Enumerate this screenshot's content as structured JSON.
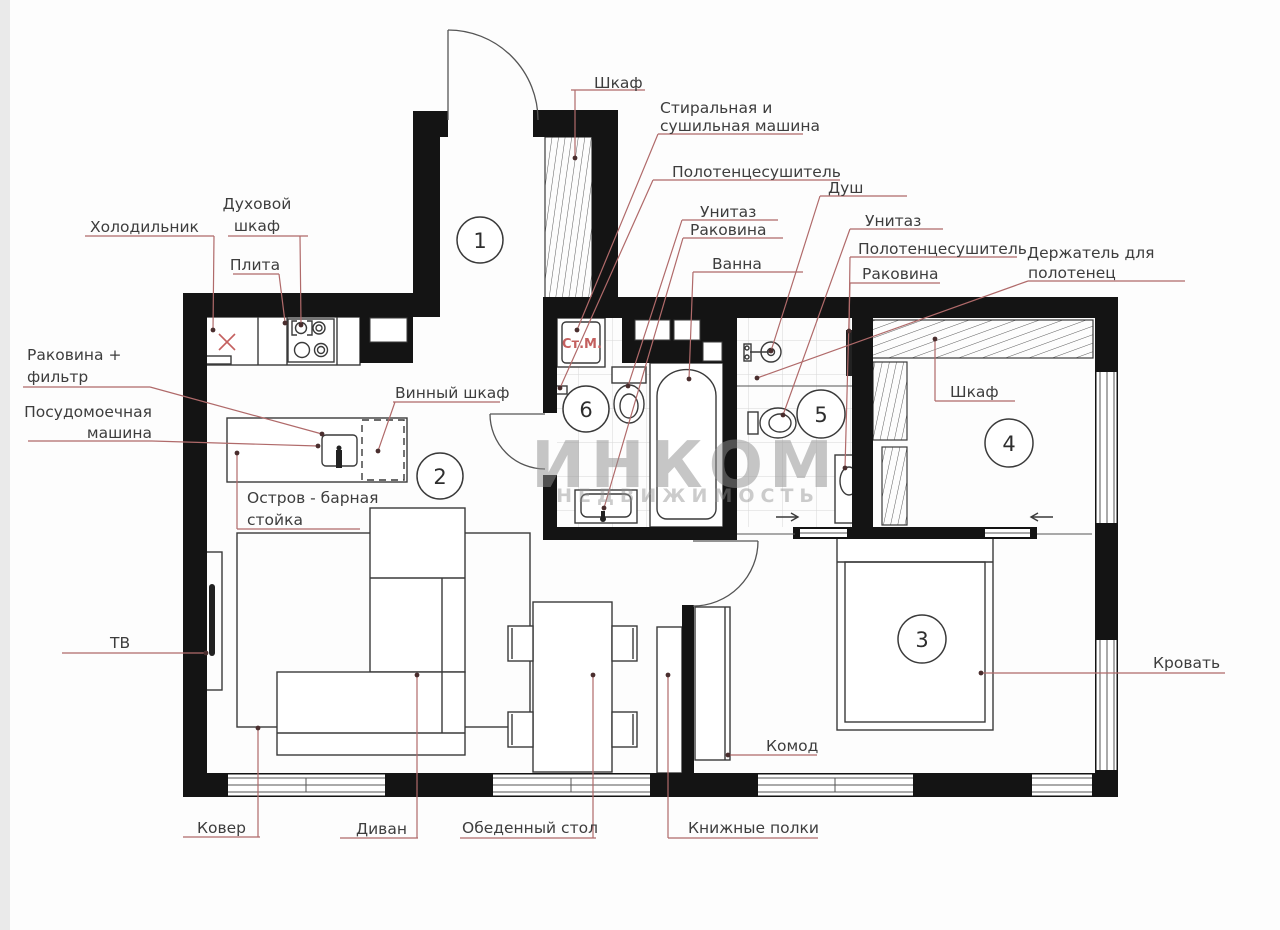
{
  "watermark": {
    "line1": "ИНКОМ",
    "line2": "НЕДВИЖИМОСТЬ"
  },
  "rooms": {
    "r1": "1",
    "r2": "2",
    "r3": "3",
    "r4": "4",
    "r5": "5",
    "r6": "6"
  },
  "labels": {
    "entry_wardrobe": "Шкаф",
    "washer_line1": "Стиральная и",
    "washer_line2": "сушильная машина",
    "towel_dryer_left": "Полотенцесушитель",
    "shower": "Душ",
    "toilet_left": "Унитаз",
    "sink_left": "Раковина",
    "bath": "Ванна",
    "toilet_right": "Унитаз",
    "towel_dryer_right": "Полотенцесушитель",
    "towel_holder_line1": "Держатель для",
    "towel_holder_line2": "полотенец",
    "sink_right": "Раковина",
    "closet_wardrobe": "Шкаф",
    "fridge": "Холодильник",
    "oven_line1": "Духовой",
    "oven_line2": "шкаф",
    "stove": "Плита",
    "sink_filter_line1": "Раковина +",
    "sink_filter_line2": "фильтр",
    "dishwasher_line1": "Посудомоечная",
    "dishwasher_line2": "машина",
    "wine_cabinet": "Винный шкаф",
    "island_line1": "Остров - барная",
    "island_line2": "стойка",
    "tv": "ТВ",
    "carpet": "Ковер",
    "sofa": "Диван",
    "dining_table": "Обеденный стол",
    "bookshelves": "Книжные полки",
    "dresser": "Комод",
    "bed": "Кровать",
    "washing_machine_abbr": "Ст.М."
  },
  "colors": {
    "wall": "#141414",
    "leader_line": "#b06a6a",
    "red_accent": "#c4605f",
    "label_text": "#3d3d3d",
    "watermark": "#8f8f8f",
    "tile_line": "#d8d8d8"
  }
}
